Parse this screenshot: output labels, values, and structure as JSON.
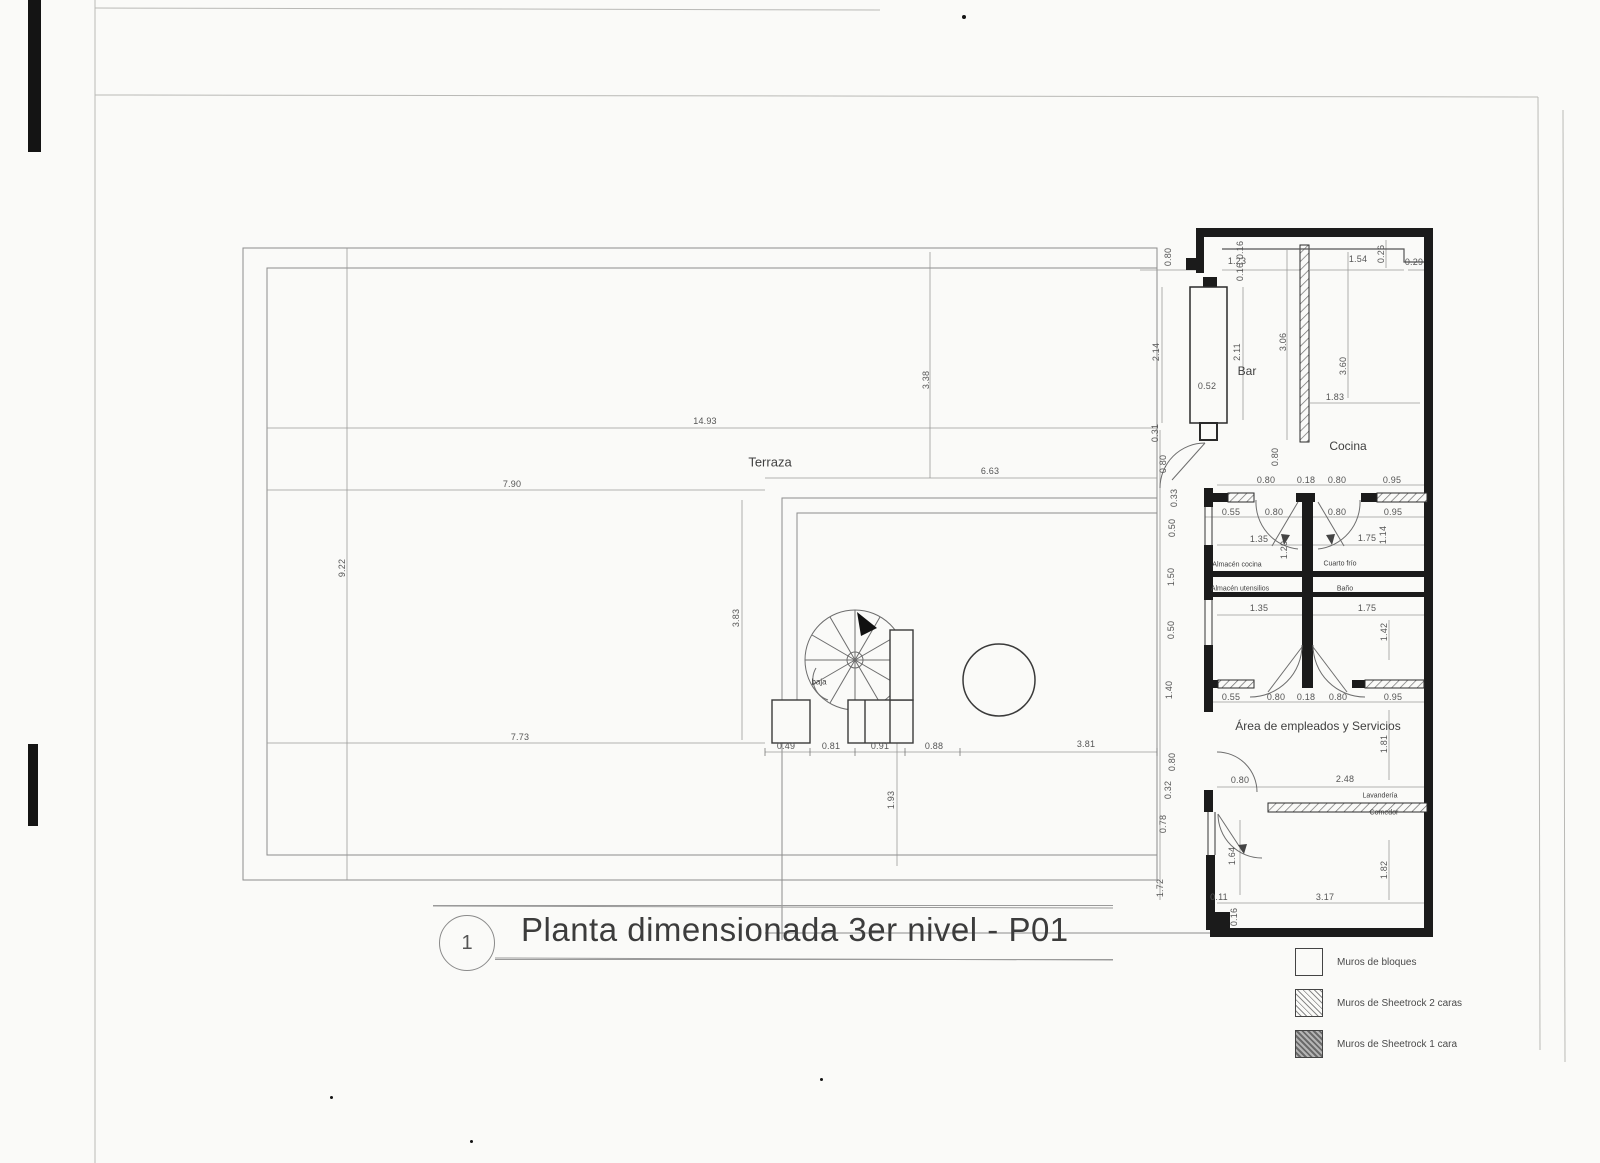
{
  "sheet": {
    "title_number": "1",
    "title": "Planta dimensionada 3er nivel - P01"
  },
  "legend": {
    "items": [
      {
        "label": "Muros de bloques",
        "style": "solid"
      },
      {
        "label": "Muros de Sheetrock 2 caras",
        "style": "hatch2"
      },
      {
        "label": "Muros de Sheetrock 1 cara",
        "style": "hatch1"
      }
    ]
  },
  "plan": {
    "rooms": [
      {
        "name": "Terraza",
        "x": 770,
        "y": 462,
        "fs": 13
      },
      {
        "name": "Bar",
        "x": 1247,
        "y": 371,
        "fs": 12
      },
      {
        "name": "Cocina",
        "x": 1348,
        "y": 446,
        "fs": 12
      },
      {
        "name": "Almacén cocina",
        "x": 1237,
        "y": 565,
        "fs": 7
      },
      {
        "name": "Cuarto frío",
        "x": 1340,
        "y": 564,
        "fs": 7
      },
      {
        "name": "Almacén utensilios",
        "x": 1240,
        "y": 589,
        "fs": 7
      },
      {
        "name": "Baño",
        "x": 1345,
        "y": 589,
        "fs": 7
      },
      {
        "name": "Área de empleados y Servicios",
        "x": 1318,
        "y": 726,
        "fs": 12
      },
      {
        "name": "Lavandería",
        "x": 1380,
        "y": 796,
        "fs": 7
      },
      {
        "name": "Comedor",
        "x": 1384,
        "y": 813,
        "fs": 7
      },
      {
        "name": "baja",
        "x": 819,
        "y": 682,
        "fs": 8
      }
    ],
    "dimensions": [
      {
        "t": "14.93",
        "x": 705,
        "y": 421
      },
      {
        "t": "7.90",
        "x": 512,
        "y": 484
      },
      {
        "t": "6.63",
        "x": 990,
        "y": 471
      },
      {
        "t": "9.22",
        "x": 342,
        "y": 568,
        "r": 1
      },
      {
        "t": "3.38",
        "x": 926,
        "y": 380,
        "r": 1
      },
      {
        "t": "3.83",
        "x": 736,
        "y": 618,
        "r": 1
      },
      {
        "t": "7.73",
        "x": 520,
        "y": 737
      },
      {
        "t": "1.93",
        "x": 891,
        "y": 800,
        "r": 1
      },
      {
        "t": "0.49",
        "x": 786,
        "y": 746
      },
      {
        "t": "0.81",
        "x": 831,
        "y": 746
      },
      {
        "t": "0.91",
        "x": 880,
        "y": 746
      },
      {
        "t": "0.88",
        "x": 934,
        "y": 746
      },
      {
        "t": "3.81",
        "x": 1086,
        "y": 744
      },
      {
        "t": "0.80",
        "x": 1168,
        "y": 257,
        "r": 1
      },
      {
        "t": "1.23",
        "x": 1237,
        "y": 261
      },
      {
        "t": "1.54",
        "x": 1358,
        "y": 259
      },
      {
        "t": "0.26",
        "x": 1381,
        "y": 254,
        "r": 1
      },
      {
        "t": "0.29",
        "x": 1414,
        "y": 262
      },
      {
        "t": "0.16",
        "x": 1240,
        "y": 250,
        "r": 1
      },
      {
        "t": "0.16",
        "x": 1240,
        "y": 272,
        "r": 1
      },
      {
        "t": "2.14",
        "x": 1156,
        "y": 352,
        "r": 1
      },
      {
        "t": "0.52",
        "x": 1207,
        "y": 386
      },
      {
        "t": "2.11",
        "x": 1237,
        "y": 352,
        "r": 1
      },
      {
        "t": "3.06",
        "x": 1283,
        "y": 342,
        "r": 1
      },
      {
        "t": "3.60",
        "x": 1343,
        "y": 366,
        "r": 1
      },
      {
        "t": "1.83",
        "x": 1335,
        "y": 397
      },
      {
        "t": "0.80",
        "x": 1275,
        "y": 457,
        "r": 1
      },
      {
        "t": "0.80",
        "x": 1266,
        "y": 480
      },
      {
        "t": "0.18",
        "x": 1306,
        "y": 480
      },
      {
        "t": "0.80",
        "x": 1337,
        "y": 480
      },
      {
        "t": "0.95",
        "x": 1392,
        "y": 480
      },
      {
        "t": "0.55",
        "x": 1231,
        "y": 512
      },
      {
        "t": "0.80",
        "x": 1274,
        "y": 512
      },
      {
        "t": "0.80",
        "x": 1337,
        "y": 512
      },
      {
        "t": "0.95",
        "x": 1393,
        "y": 512
      },
      {
        "t": "1.35",
        "x": 1259,
        "y": 539
      },
      {
        "t": "1.20",
        "x": 1284,
        "y": 550,
        "r": 1
      },
      {
        "t": "1.75",
        "x": 1367,
        "y": 538
      },
      {
        "t": "1.14",
        "x": 1383,
        "y": 535,
        "r": 1
      },
      {
        "t": "1.35",
        "x": 1259,
        "y": 608
      },
      {
        "t": "1.75",
        "x": 1367,
        "y": 608
      },
      {
        "t": "1.42",
        "x": 1384,
        "y": 632,
        "r": 1
      },
      {
        "t": "0.31",
        "x": 1155,
        "y": 433,
        "r": 1
      },
      {
        "t": "0.80",
        "x": 1163,
        "y": 464,
        "r": 1
      },
      {
        "t": "0.33",
        "x": 1174,
        "y": 498,
        "r": 1
      },
      {
        "t": "0.50",
        "x": 1172,
        "y": 528,
        "r": 1
      },
      {
        "t": "1.50",
        "x": 1171,
        "y": 577,
        "r": 1
      },
      {
        "t": "0.50",
        "x": 1171,
        "y": 630,
        "r": 1
      },
      {
        "t": "1.40",
        "x": 1169,
        "y": 690,
        "r": 1
      },
      {
        "t": "0.55",
        "x": 1231,
        "y": 697
      },
      {
        "t": "0.80",
        "x": 1276,
        "y": 697
      },
      {
        "t": "0.18",
        "x": 1306,
        "y": 697
      },
      {
        "t": "0.80",
        "x": 1338,
        "y": 697
      },
      {
        "t": "0.95",
        "x": 1393,
        "y": 697
      },
      {
        "t": "1.81",
        "x": 1384,
        "y": 744,
        "r": 1
      },
      {
        "t": "2.48",
        "x": 1345,
        "y": 779
      },
      {
        "t": "0.80",
        "x": 1240,
        "y": 780
      },
      {
        "t": "0.80",
        "x": 1172,
        "y": 762,
        "r": 1
      },
      {
        "t": "0.32",
        "x": 1168,
        "y": 790,
        "r": 1
      },
      {
        "t": "0.78",
        "x": 1163,
        "y": 824,
        "r": 1
      },
      {
        "t": "1.72",
        "x": 1160,
        "y": 888,
        "r": 1
      },
      {
        "t": "1.64",
        "x": 1232,
        "y": 856,
        "r": 1
      },
      {
        "t": "1.82",
        "x": 1384,
        "y": 870,
        "r": 1
      },
      {
        "t": "3.17",
        "x": 1325,
        "y": 897
      },
      {
        "t": "0.11",
        "x": 1219,
        "y": 897
      },
      {
        "t": "0.16",
        "x": 1234,
        "y": 917,
        "r": 1
      }
    ]
  }
}
